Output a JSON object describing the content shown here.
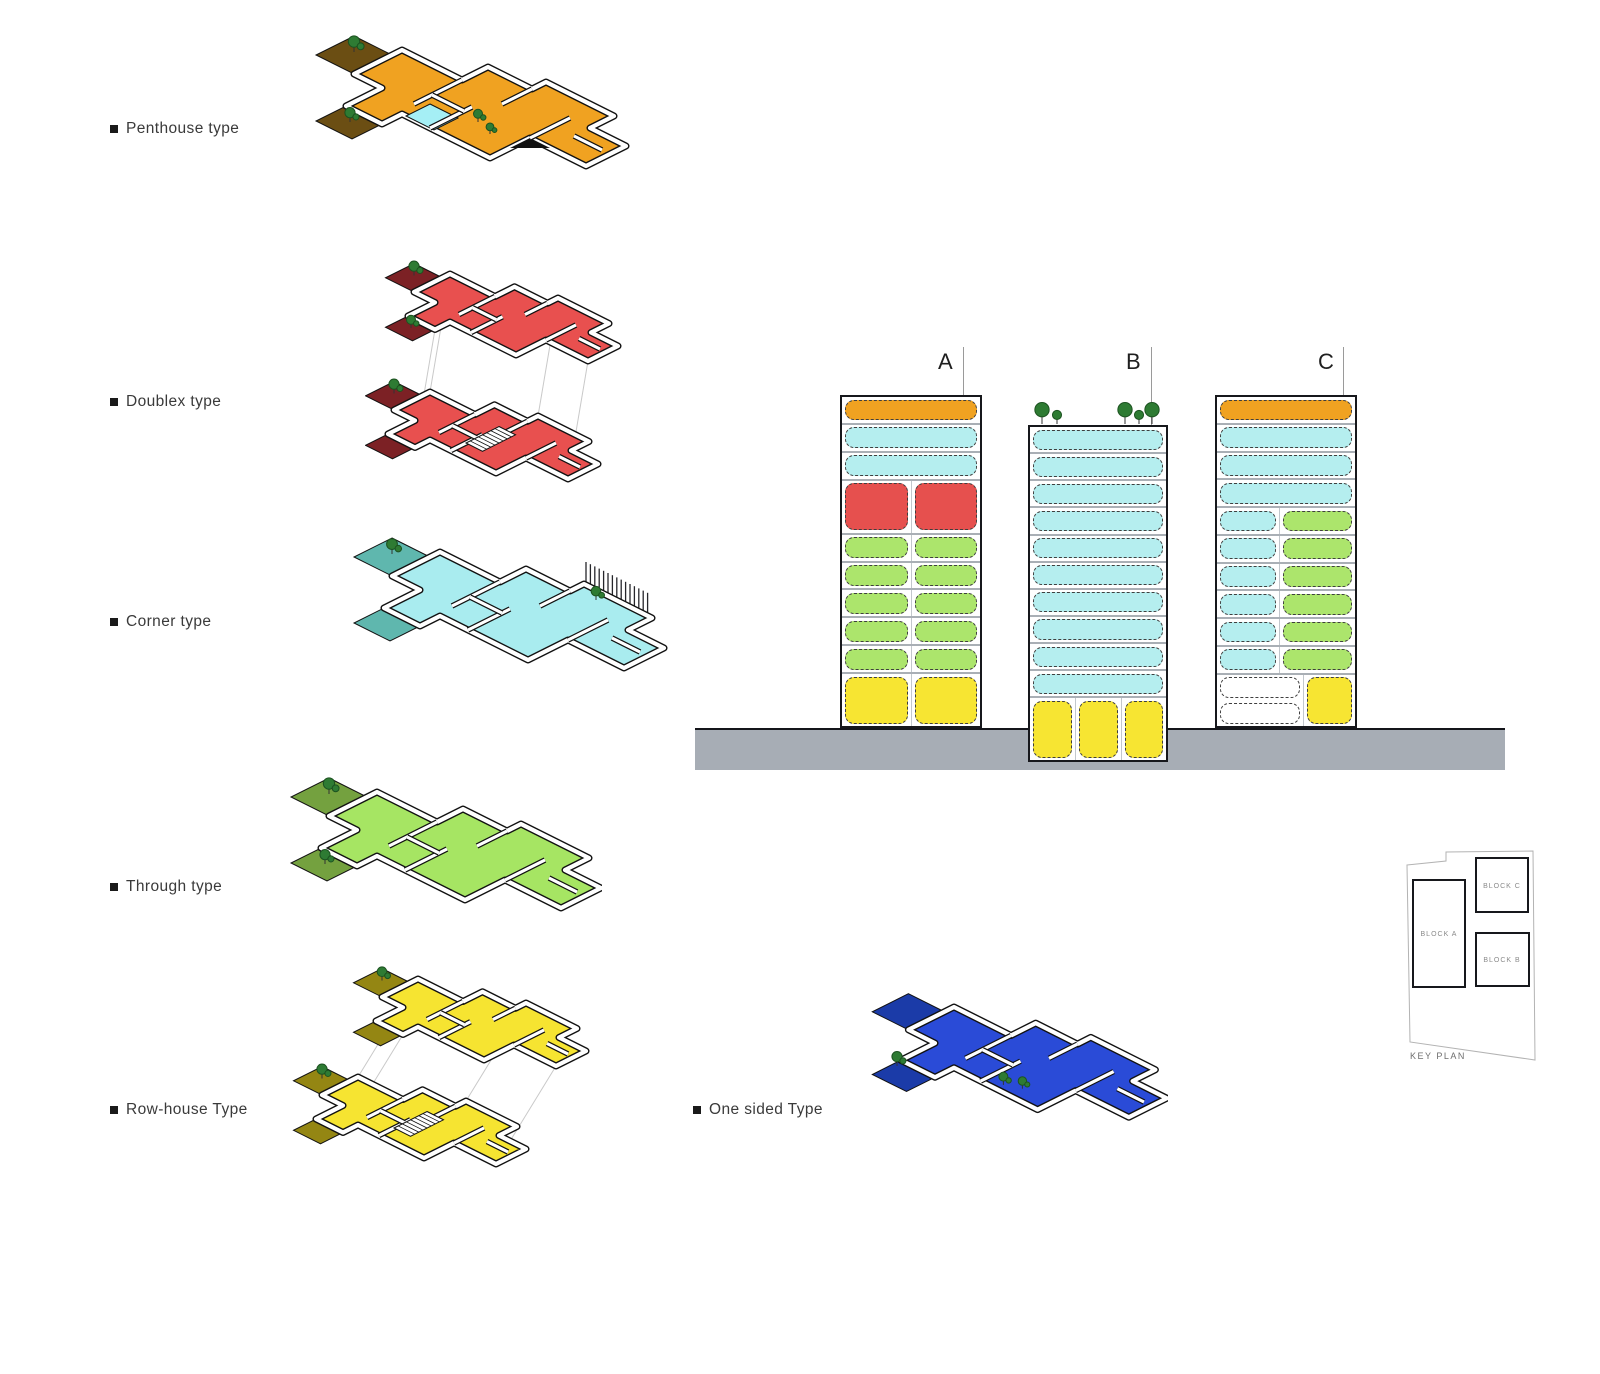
{
  "palette": {
    "orange": "#F0A221",
    "cyan": "#B5EEEF",
    "red": "#E6504E",
    "green": "#ACE56C",
    "yellow": "#F7E532",
    "white": "#FFFFFF",
    "ground": "#A7ADB5",
    "tree_fill": "#2E7B33",
    "tree_stroke": "#1C5220",
    "pool": "#A5EFF5"
  },
  "unit_types": [
    {
      "label": "Penthouse type",
      "color": "#F0A221",
      "terrace": "#6B4E13",
      "variant": "penthouse"
    },
    {
      "label": "Doublex type",
      "color": "#E8504F",
      "terrace": "#7C2125",
      "variant": "duplex"
    },
    {
      "label": "Corner type",
      "color": "#A9ECEF",
      "terrace": "#5FB7AE",
      "variant": "corner"
    },
    {
      "label": "Through type",
      "color": "#A6E563",
      "terrace": "#74A13F",
      "variant": "single"
    },
    {
      "label": "Row-house Type",
      "color": "#F6E431",
      "terrace": "#948613",
      "variant": "rowhouse"
    },
    {
      "label": "One sided Type",
      "color": "#2A4BD7",
      "terrace": "#1B3BA8",
      "variant": "onesided"
    }
  ],
  "sections": {
    "block_labels": [
      "A",
      "B",
      "C"
    ],
    "blocks": [
      {
        "name": "A",
        "floors": [
          {
            "h": 1,
            "cols": [
              {
                "w": 1,
                "rows": [
                  "orange"
                ]
              }
            ]
          },
          {
            "h": 1,
            "cols": [
              {
                "w": 1,
                "rows": [
                  "cyan"
                ]
              }
            ]
          },
          {
            "h": 1,
            "cols": [
              {
                "w": 1,
                "rows": [
                  "cyan"
                ]
              }
            ]
          },
          {
            "h": 2,
            "cols": [
              {
                "w": 0.5,
                "rows": [
                  "red"
                ]
              },
              {
                "w": 0.5,
                "rows": [
                  "red"
                ]
              }
            ]
          },
          {
            "h": 1,
            "cols": [
              {
                "w": 0.5,
                "rows": [
                  "green"
                ]
              },
              {
                "w": 0.5,
                "rows": [
                  "green"
                ]
              }
            ]
          },
          {
            "h": 1,
            "cols": [
              {
                "w": 0.5,
                "rows": [
                  "green"
                ]
              },
              {
                "w": 0.5,
                "rows": [
                  "green"
                ]
              }
            ]
          },
          {
            "h": 1,
            "cols": [
              {
                "w": 0.5,
                "rows": [
                  "green"
                ]
              },
              {
                "w": 0.5,
                "rows": [
                  "green"
                ]
              }
            ]
          },
          {
            "h": 1,
            "cols": [
              {
                "w": 0.5,
                "rows": [
                  "green"
                ]
              },
              {
                "w": 0.5,
                "rows": [
                  "green"
                ]
              }
            ]
          },
          {
            "h": 1,
            "cols": [
              {
                "w": 0.5,
                "rows": [
                  "green"
                ]
              },
              {
                "w": 0.5,
                "rows": [
                  "green"
                ]
              }
            ]
          },
          {
            "h": 2,
            "cols": [
              {
                "w": 0.5,
                "rows": [
                  "yellow"
                ]
              },
              {
                "w": 0.5,
                "rows": [
                  "yellow"
                ]
              }
            ]
          }
        ]
      },
      {
        "name": "B",
        "floors": [
          {
            "h": 1,
            "cols": [
              {
                "w": 1,
                "rows": [
                  "cyan"
                ]
              }
            ]
          },
          {
            "h": 1,
            "cols": [
              {
                "w": 1,
                "rows": [
                  "cyan"
                ]
              }
            ]
          },
          {
            "h": 1,
            "cols": [
              {
                "w": 1,
                "rows": [
                  "cyan"
                ]
              }
            ]
          },
          {
            "h": 1,
            "cols": [
              {
                "w": 1,
                "rows": [
                  "cyan"
                ]
              }
            ]
          },
          {
            "h": 1,
            "cols": [
              {
                "w": 1,
                "rows": [
                  "cyan"
                ]
              }
            ]
          },
          {
            "h": 1,
            "cols": [
              {
                "w": 1,
                "rows": [
                  "cyan"
                ]
              }
            ]
          },
          {
            "h": 1,
            "cols": [
              {
                "w": 1,
                "rows": [
                  "cyan"
                ]
              }
            ]
          },
          {
            "h": 1,
            "cols": [
              {
                "w": 1,
                "rows": [
                  "cyan"
                ]
              }
            ]
          },
          {
            "h": 1,
            "cols": [
              {
                "w": 1,
                "rows": [
                  "cyan"
                ]
              }
            ]
          },
          {
            "h": 1,
            "cols": [
              {
                "w": 1,
                "rows": [
                  "cyan"
                ]
              }
            ]
          },
          {
            "h": 2.45,
            "cols": [
              {
                "w": 0.333,
                "rows": [
                  "yellow"
                ]
              },
              {
                "w": 0.333,
                "rows": [
                  "yellow"
                ]
              },
              {
                "w": 0.334,
                "rows": [
                  "yellow"
                ]
              }
            ]
          }
        ]
      },
      {
        "name": "C",
        "floors": [
          {
            "h": 1,
            "cols": [
              {
                "w": 1,
                "rows": [
                  "orange"
                ]
              }
            ]
          },
          {
            "h": 1,
            "cols": [
              {
                "w": 1,
                "rows": [
                  "cyan"
                ]
              }
            ]
          },
          {
            "h": 1,
            "cols": [
              {
                "w": 1,
                "rows": [
                  "cyan"
                ]
              }
            ]
          },
          {
            "h": 1,
            "cols": [
              {
                "w": 1,
                "rows": [
                  "cyan"
                ]
              }
            ]
          },
          {
            "h": 1,
            "cols": [
              {
                "w": 0.45,
                "rows": [
                  "cyan"
                ]
              },
              {
                "w": 0.55,
                "rows": [
                  "green"
                ]
              }
            ]
          },
          {
            "h": 1,
            "cols": [
              {
                "w": 0.45,
                "rows": [
                  "cyan"
                ]
              },
              {
                "w": 0.55,
                "rows": [
                  "green"
                ]
              }
            ]
          },
          {
            "h": 1,
            "cols": [
              {
                "w": 0.45,
                "rows": [
                  "cyan"
                ]
              },
              {
                "w": 0.55,
                "rows": [
                  "green"
                ]
              }
            ]
          },
          {
            "h": 1,
            "cols": [
              {
                "w": 0.45,
                "rows": [
                  "cyan"
                ]
              },
              {
                "w": 0.55,
                "rows": [
                  "green"
                ]
              }
            ]
          },
          {
            "h": 1,
            "cols": [
              {
                "w": 0.45,
                "rows": [
                  "cyan"
                ]
              },
              {
                "w": 0.55,
                "rows": [
                  "green"
                ]
              }
            ]
          },
          {
            "h": 1,
            "cols": [
              {
                "w": 0.45,
                "rows": [
                  "cyan"
                ]
              },
              {
                "w": 0.55,
                "rows": [
                  "green"
                ]
              }
            ]
          },
          {
            "h": 2,
            "cols": [
              {
                "w": 0.62,
                "rows": [
                  "white",
                  "white"
                ]
              },
              {
                "w": 0.38,
                "rows": [
                  "yellow"
                ]
              }
            ]
          }
        ]
      }
    ]
  },
  "keyplan": {
    "title": "KEY PLAN",
    "block_a": "BLOCK A",
    "block_b": "BLOCK B",
    "block_c": "BLOCK C"
  }
}
